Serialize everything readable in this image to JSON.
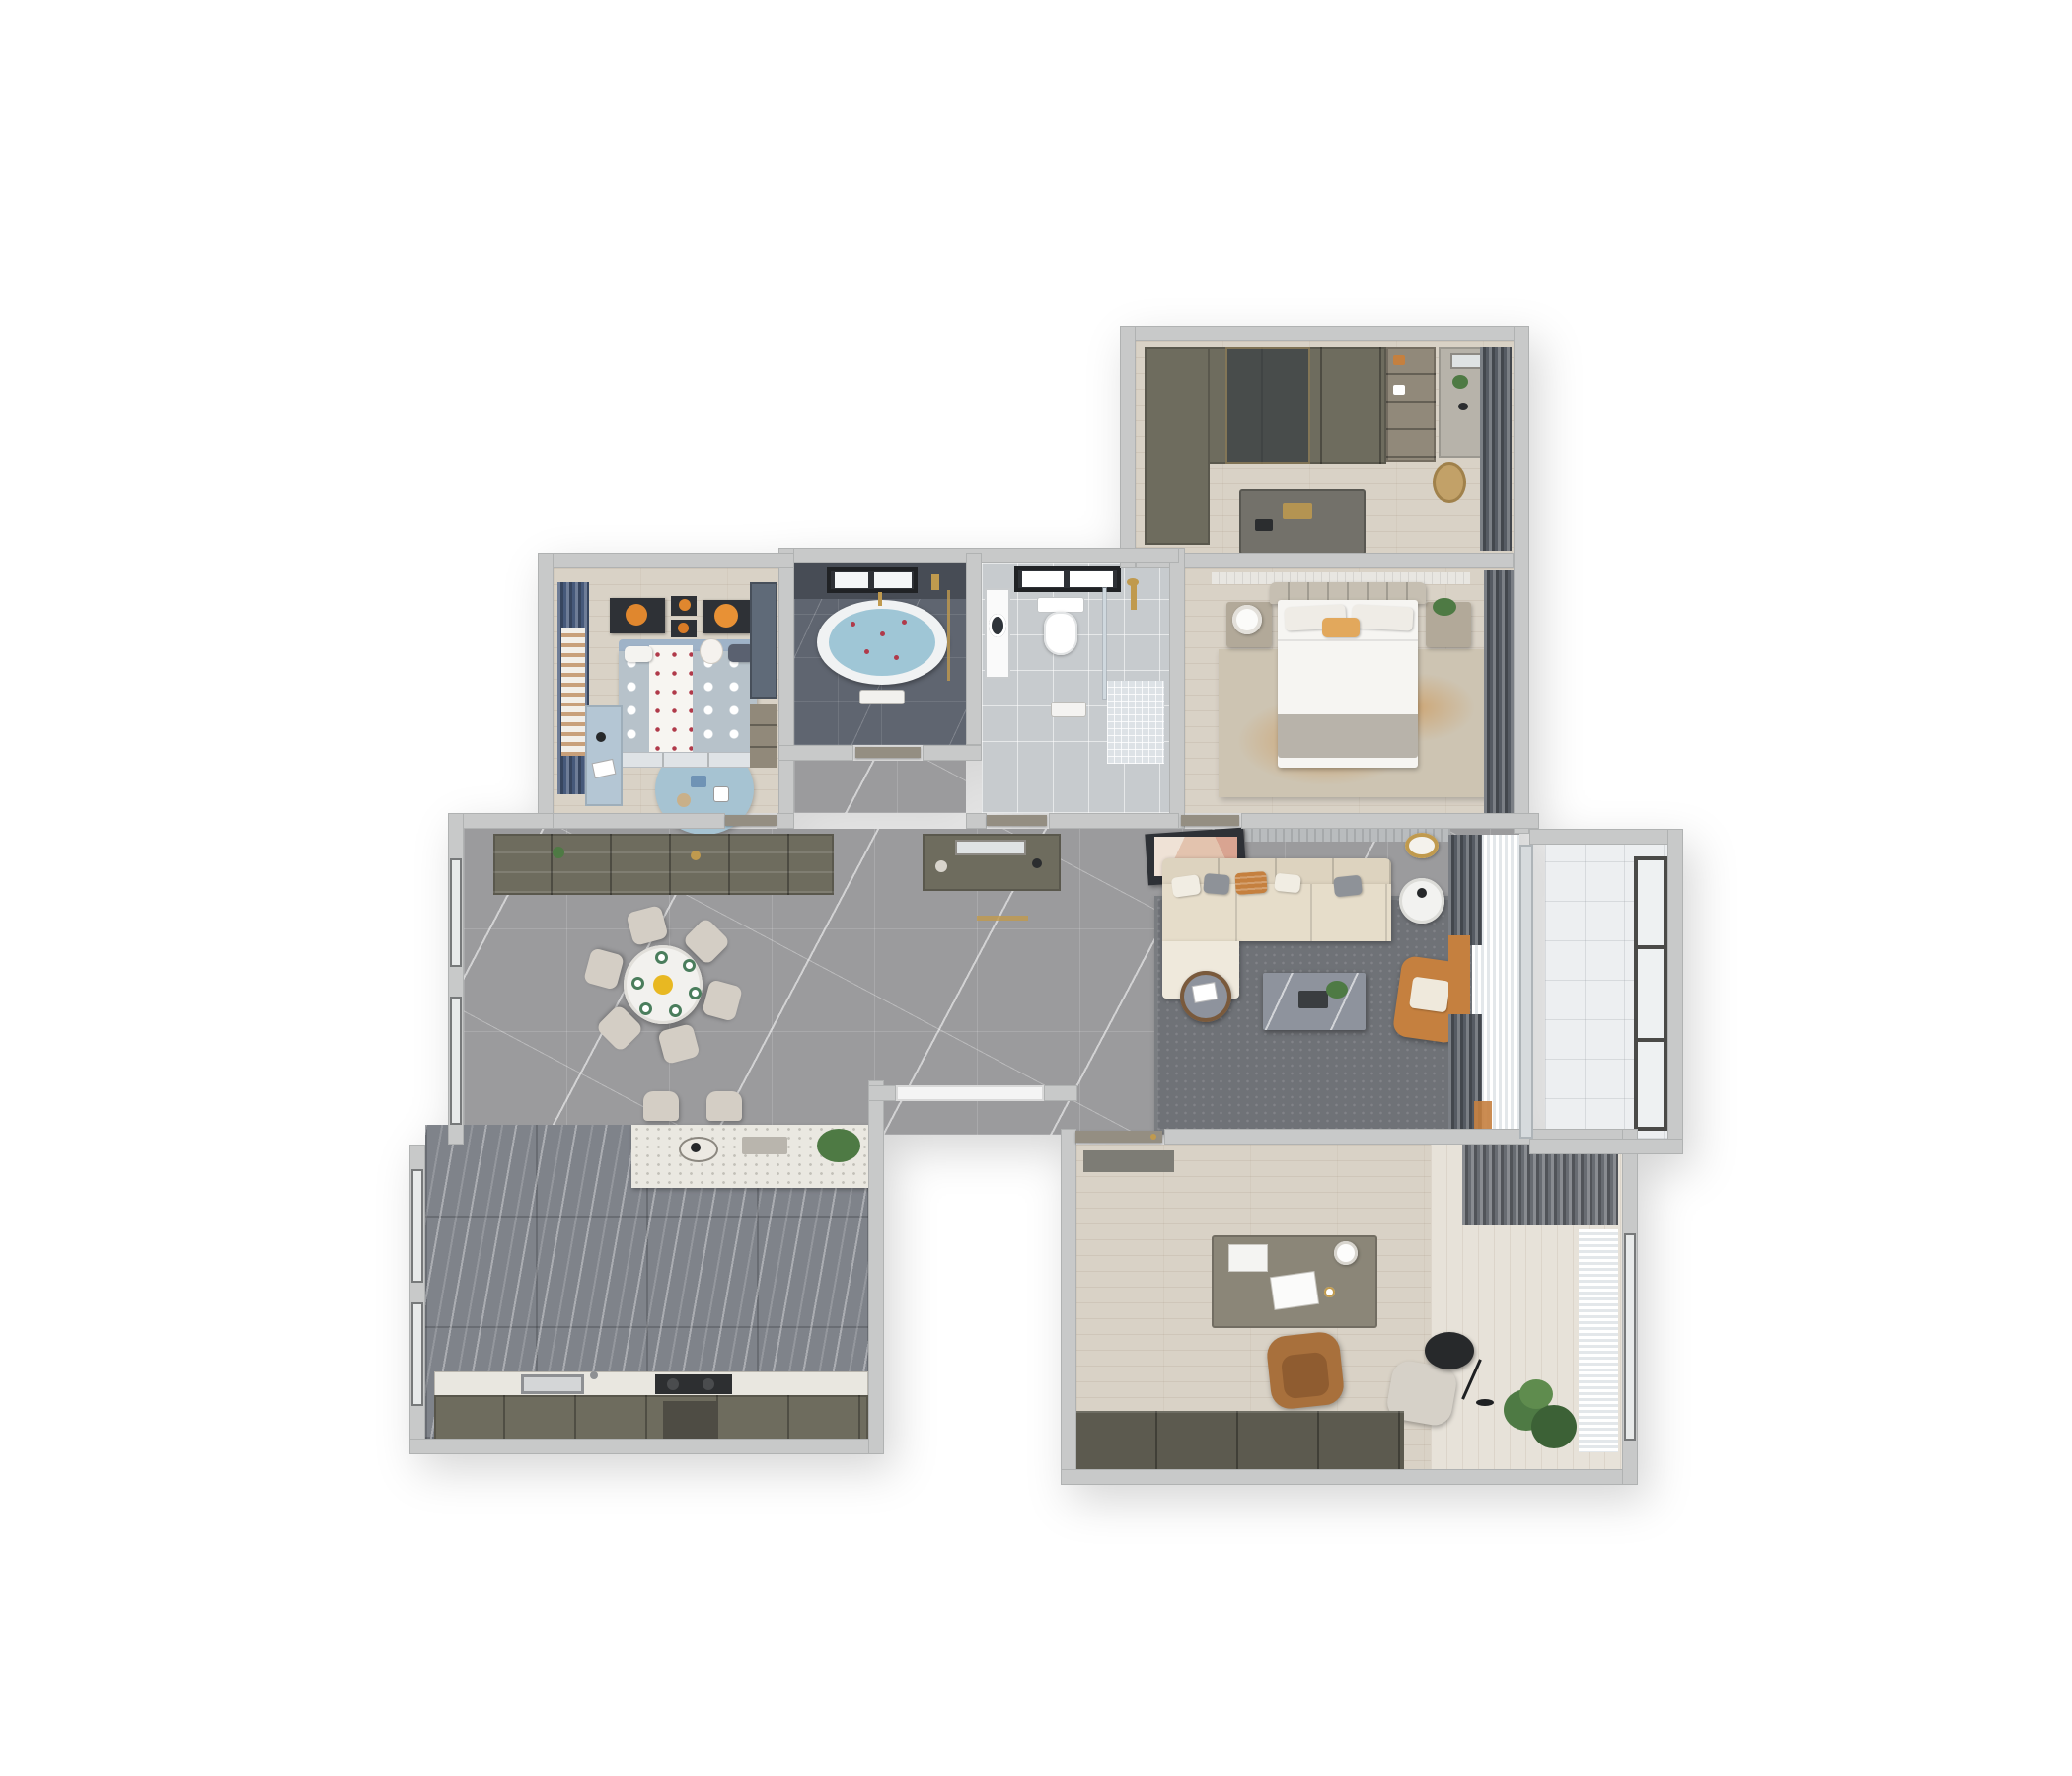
{
  "meta": {
    "kind": "3d-floor-plan-render",
    "view": "top-down dollhouse cutaway",
    "background": "#ffffff",
    "visible_text": "none"
  },
  "palette": {
    "bg": "#ffffff",
    "wall": "#c8c9c9",
    "wallEdge": "#b0b2b2",
    "glass": "#d6dadd",
    "woodFloor": "#d9d2c6",
    "studyBay": "#e7e2d9",
    "marble": "#9b9b9d",
    "darkTile": "#7f838a",
    "bathDarkWall": "#474c55",
    "bathDarkFloor": "#5f6570",
    "bathLightFloor": "#c7cbce",
    "balconyFloor": "#edeff1",
    "olive": "#6e6c5e",
    "oliveDark": "#5c5a4f",
    "deskOlive": "#8b8678",
    "doorOlive": "#948e82",
    "shelfTan": "#91897a",
    "cream": "#e6ddca",
    "creamLight": "#efe9dc",
    "rugLiving": "#6f7277",
    "rugBedroom": "#cdc4b2",
    "orange": "#c5803f",
    "orangeSoft": "#e2a85c",
    "navy": "#46597a",
    "kidsBlue": "#b7c2ca",
    "kidsRug": "#a6c3d2",
    "babyBlue": "#b4c6d4",
    "white": "#f6f5f2",
    "gold": "#c09a4e",
    "curtainDark": "#565b63",
    "sheer": "#f0f2f3",
    "tubWater": "#9fc6d6",
    "petal": "#b03a4a",
    "plant": "#4e7a44",
    "plantDark": "#3c6136",
    "marbleTable": "#8e939d",
    "frameDark": "#2e3136",
    "artPeach": "#e3c3ae",
    "terrazzo": "#eae8e1",
    "counterTop": "#e9e7e0",
    "cooktop": "#2d2f31",
    "blanket": "#b8b3aa",
    "headboard": "#c6bfb2",
    "nightstand": "#b2a999",
    "chairBrown": "#a8703c",
    "loungeGray": "#d6d1c8",
    "tan": "#c2a168",
    "matGray": "#7d7c75",
    "blindStripe": "#c8a07a"
  },
  "rooms": [
    {
      "id": "dressing-room",
      "name": "Walk-in closet / dressing room",
      "floor": "light wood",
      "furniture": [
        "wardrobe run",
        "glass-front wardrobe",
        "open shelving with bags",
        "vanity with mirror and plants",
        "island dresser with trays",
        "rattan basket",
        "dark window curtains"
      ]
    },
    {
      "id": "master-bedroom",
      "name": "Master bedroom",
      "floor": "light wood",
      "furniture": [
        "double bed with white duvet",
        "slatted headboard",
        "two white pillows",
        "orange accent pillow",
        "gray foot blanket",
        "left nightstand with round lamp",
        "right nightstand with plant",
        "distressed beige-orange area rug",
        "dark curtains at window wall"
      ]
    },
    {
      "id": "kids-bedroom",
      "name": "Kids bedroom",
      "floor": "light wood",
      "furniture": [
        "bed with polka-dot duvet",
        "white runner with red dots",
        "teddy bear",
        "gray headboard cushion",
        "footboard drawers",
        "wall art with orange planets",
        "navy curtains",
        "striped roller blind",
        "light-blue desk cabinet with lamp",
        "tall wardrobe",
        "open shelf unit",
        "round play rug with toys"
      ]
    },
    {
      "id": "master-bathroom",
      "name": "Master bathroom (tub)",
      "floor": "dark slate tile",
      "furniture": [
        "freestanding oval bathtub with rose petals",
        "black-framed window",
        "gold shower fixture",
        "glass screen",
        "towel tray"
      ]
    },
    {
      "id": "shower-bathroom",
      "name": "Shower bathroom",
      "floor": "gray tile + mosaic shower zone",
      "furniture": [
        "black-framed window",
        "wall-hung toilet",
        "vanity counter with dark basin",
        "glass shower partition",
        "gold shower column",
        "slipper tray"
      ]
    },
    {
      "id": "dining-room",
      "name": "Dining room",
      "floor": "gray marble tile",
      "furniture": [
        "round marble dining table",
        "six upholstered chairs",
        "six green-rim place settings",
        "yellow flower centerpiece",
        "display / wine cabinet",
        "tall mullioned windows"
      ]
    },
    {
      "id": "hallway",
      "name": "Entry hallway",
      "floor": "gray marble tile",
      "furniture": [
        "entry console with mirror and decor",
        "gold floor threshold",
        "front door opening"
      ]
    },
    {
      "id": "living-room",
      "name": "Living room",
      "floor": "gray marble tile",
      "furniture": [
        "L-shaped cream sectional sofa with chaise",
        "five throw pillows",
        "gray marble coffee table with tray and plant",
        "white round side table",
        "small round marble accent table",
        "orange leather armchair with white cushion",
        "large dark gray area rug",
        "black-framed peach abstract wall art",
        "round gold ceiling lamp",
        "layered gray-orange curtains with sheers"
      ]
    },
    {
      "id": "balcony",
      "name": "Balcony",
      "floor": "white tile",
      "furniture": [
        "floor-to-ceiling three-pane window",
        "glass partition to living room"
      ]
    },
    {
      "id": "kitchen",
      "name": "Kitchen",
      "floor": "dark striped marble tile",
      "furniture": [
        "terrazzo island counter",
        "two cream bar stools",
        "serving tray",
        "cutting board",
        "potted plant",
        "olive base cabinets",
        "white countertop",
        "sink with faucet",
        "black cooktop",
        "tall mullioned windows"
      ]
    },
    {
      "id": "study",
      "name": "Study / office",
      "floor": "light wood with window bay",
      "furniture": [
        "olive writing desk",
        "white laptop",
        "desk lamp",
        "papers and cup",
        "brown leather office chair",
        "gray lounge chair",
        "black arc floor lamp",
        "potted plant",
        "low dark cabinet",
        "entry door with gold handle",
        "dark door mat",
        "gray curtains",
        "sheer bay curtain"
      ]
    }
  ]
}
